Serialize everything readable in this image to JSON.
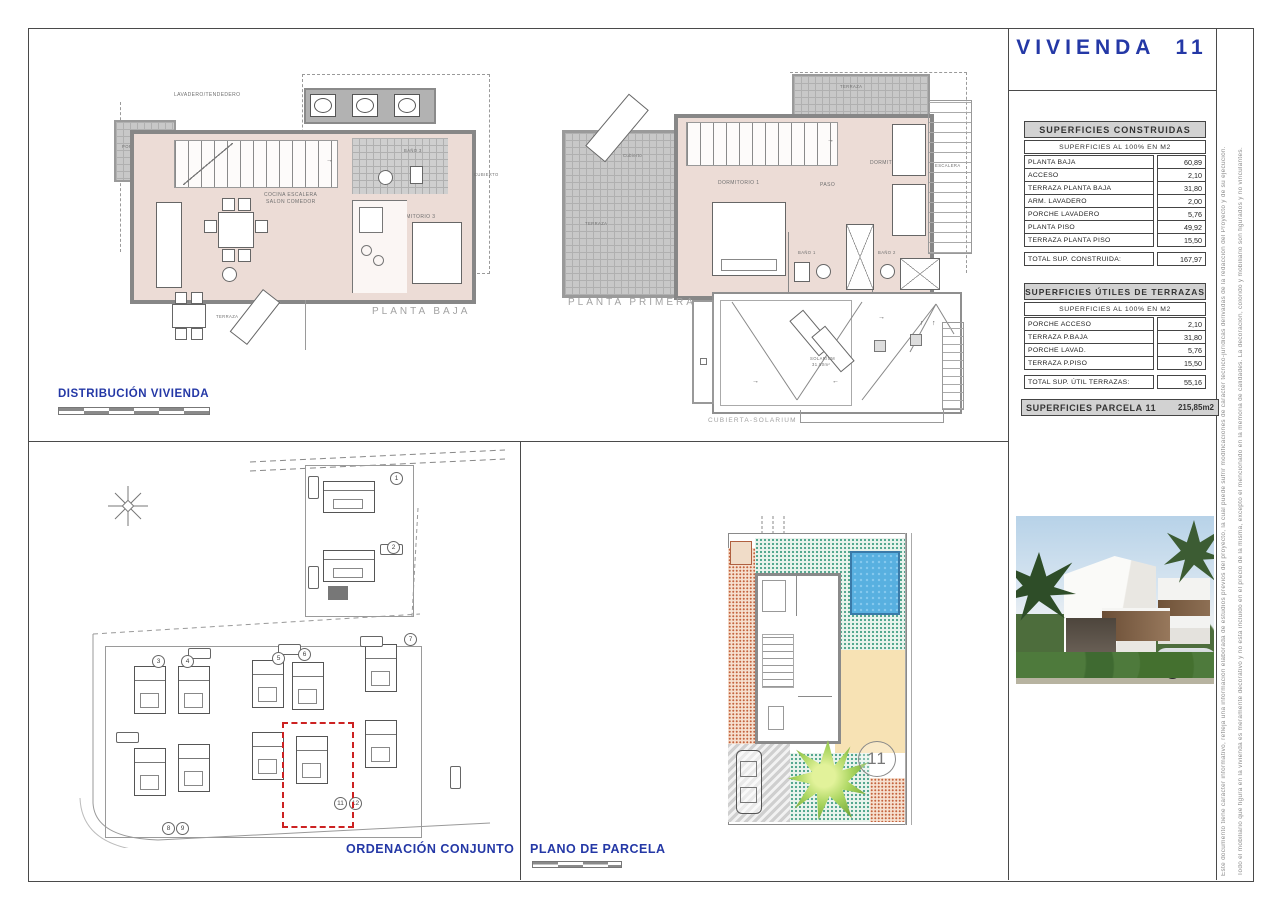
{
  "colors": {
    "accent_blue": "#2438a6",
    "highlight_red": "#cc2222",
    "pool_blue": "#58b0e0",
    "plan_pink": "#ecdcd6"
  },
  "title": {
    "text": "VIVIENDA  11"
  },
  "tables": {
    "construidas": {
      "title": "SUPERFICIES  CONSTRUIDAS",
      "subtitle": "SUPERFICIES  AL  100%  EN  M2",
      "rows": [
        {
          "label": "PLANTA  BAJA",
          "value": "60,89"
        },
        {
          "label": "ACCESO",
          "value": "2,10"
        },
        {
          "label": "TERRAZA  PLANTA  BAJA",
          "value": "31,80"
        },
        {
          "label": "ARM.  LAVADERO",
          "value": "2,00"
        },
        {
          "label": "PORCHE  LAVADERO",
          "value": "5,76"
        },
        {
          "label": "PLANTA  PISO",
          "value": "49,92"
        },
        {
          "label": "TERRAZA  PLANTA  PISO",
          "value": "15,50"
        }
      ],
      "total_label": "TOTAL  SUP.  CONSTRUIDA:",
      "total_value": "167,97"
    },
    "terrazas": {
      "title": "SUPERFICIES  ÚTILES  DE  TERRAZAS",
      "subtitle": "SUPERFICIES  AL  100%  EN  M2",
      "rows": [
        {
          "label": "PORCHE  ACCESO",
          "value": "2,10"
        },
        {
          "label": "TERRAZA  P.BAJA",
          "value": "31,80"
        },
        {
          "label": "PORCHE  LAVAD.",
          "value": "5,76"
        },
        {
          "label": "TERRAZA  P.PISO",
          "value": "15,50"
        }
      ],
      "total_label": "TOTAL  SUP.  ÚTIL  TERRAZAS:",
      "total_value": "55,16"
    },
    "parcela": {
      "label": "SUPERFICIES  PARCELA  11",
      "value": "215,85m2"
    }
  },
  "plans": {
    "planta_baja": {
      "caption": "PLANTA BAJA",
      "labels": {
        "lavadero": "LAVADERO/TENDEDERO",
        "porche": "PORCHE ACC.",
        "bano3": "BAÑO 3",
        "cubierto": "CUBIERTO",
        "cocina": "COCINA ESCALERA",
        "salon": "SALON COMEDOR",
        "dormitorio3": "DORMITORIO 3",
        "terraza": "TERRAZA"
      }
    },
    "planta_primera": {
      "caption": "PLANTA PRIMERA",
      "labels": {
        "terraza_top": "TERRAZA",
        "cubierto": "Cubierto",
        "terraza": "TERRAZA",
        "dormitorio1": "DORMITORIO 1",
        "paso": "PASO",
        "dormitorio2": "DORMITORIO 2",
        "bano1": "BAÑO 1",
        "bano2": "BAÑO 2",
        "escalera": "ESCALERA"
      }
    },
    "solarium": {
      "caption": "CUBIERTA-SOLARIUM",
      "labels": {
        "solarium": "SOLARIUM",
        "area": "31,80m²"
      }
    },
    "distribucion": {
      "caption": "DISTRIBUCIÓN  VIVIENDA"
    },
    "ordenacion": {
      "caption": "ORDENACIÓN CONJUNTO",
      "plot_numbers": [
        "1",
        "2",
        "3",
        "4",
        "5",
        "6",
        "7",
        "8",
        "9",
        "11",
        "12"
      ]
    },
    "parcela_plan": {
      "caption": "PLANO DE PARCELA",
      "plot_number": "11"
    }
  },
  "side_notes": {
    "line1": "Este documento tiene carácter informativo, refleja una información elaborada de estudios previos del proyecto, la cual puede sufrir modificaciones de carácter técnico-jurídicas derivadas de la redacción del Proyecto y de su ejecución.",
    "line2": "Todo el mobiliario que figura en la vivienda es meramente decorativo y no está incluido en el precio de la misma, excepto el mencionado en la memoria de calidades. La decoración, colorido y mobiliario son figurados y no vinculantes."
  }
}
